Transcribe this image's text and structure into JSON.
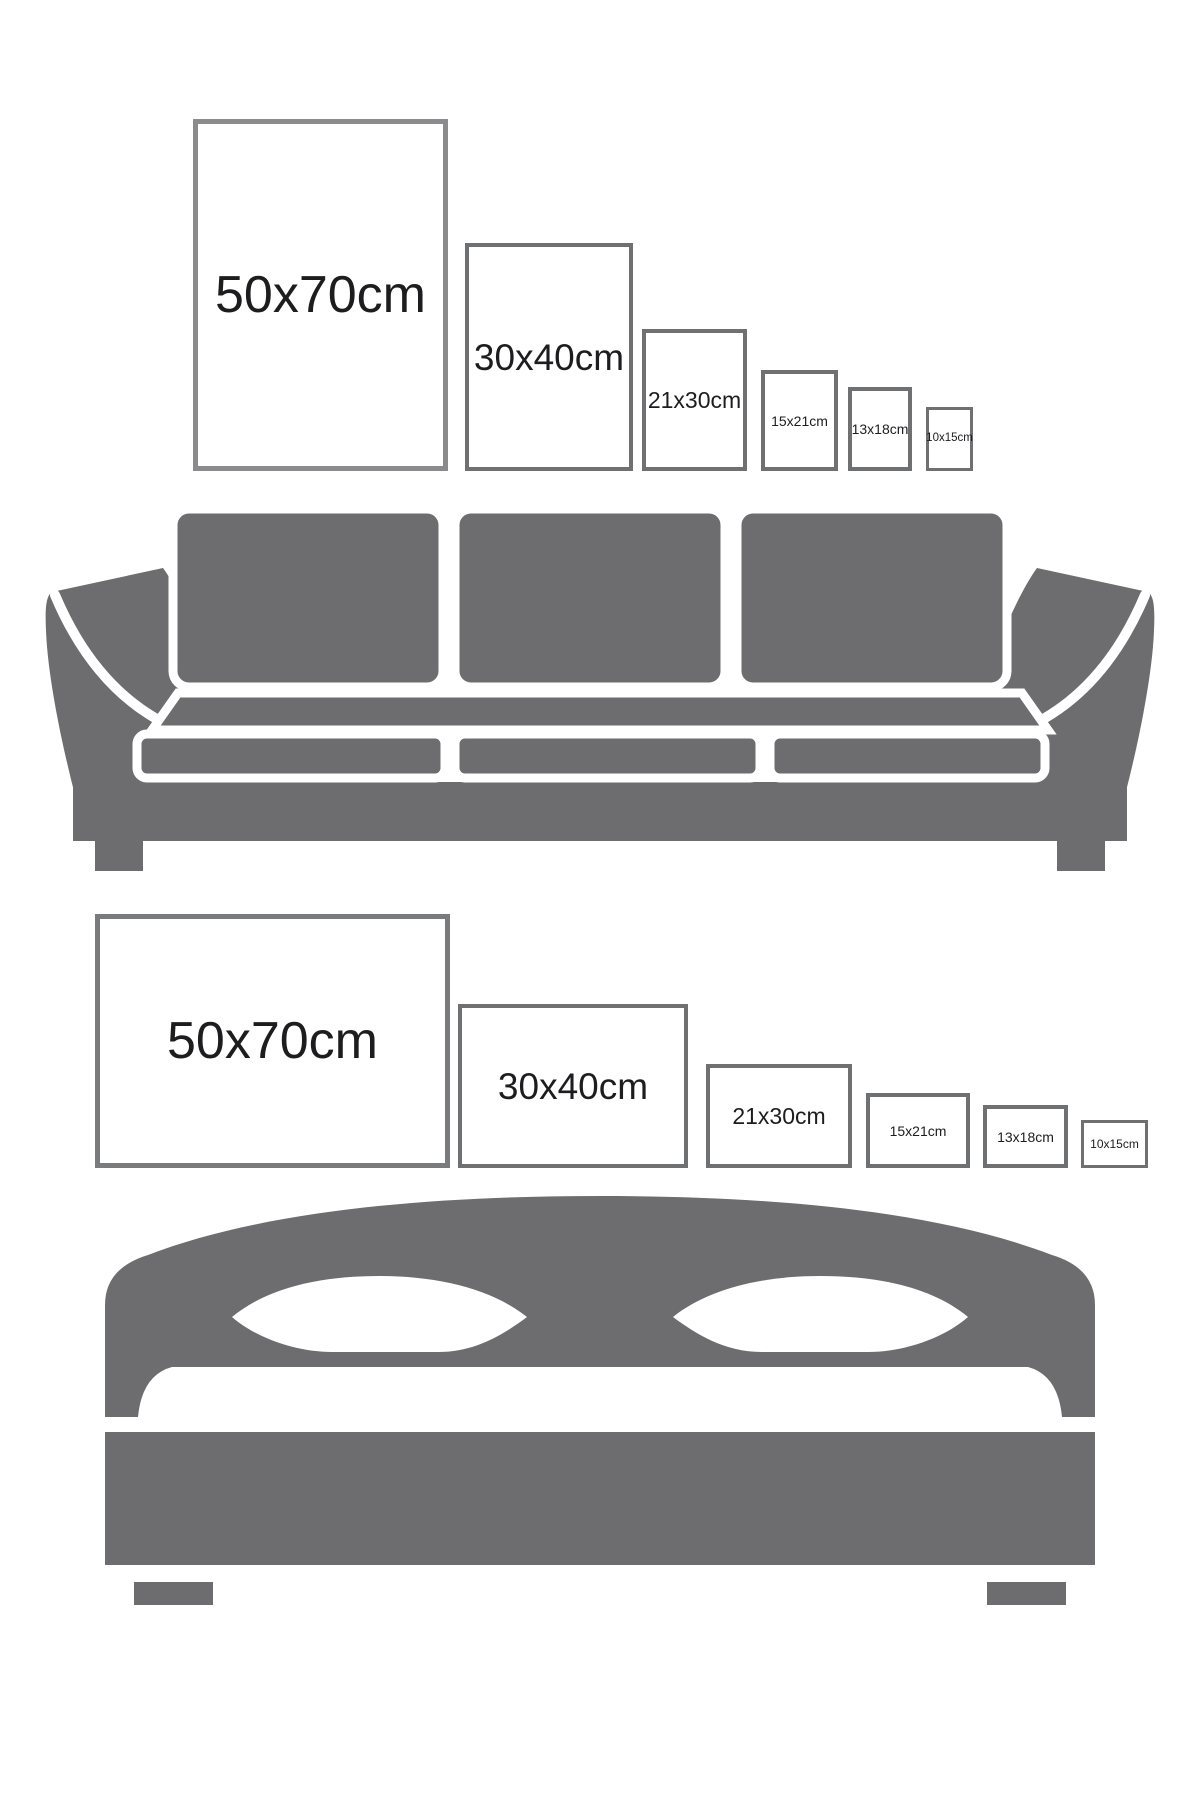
{
  "diagram_title": "Poster size comparison guide",
  "colors": {
    "furniture_gray": "#6d6d6f",
    "frame_border": "#6f7072",
    "frame_border_large_top": "#8b8b8d",
    "frame_border_large_bottom": "#7a7b7d",
    "label_text": "#1d1d1f",
    "background": "#ffffff"
  },
  "top_section": {
    "furniture_icon": "sofa-icon",
    "frame_orientation": "portrait",
    "frames": [
      {
        "label": "50x70cm"
      },
      {
        "label": "30x40cm"
      },
      {
        "label": "21x30cm"
      },
      {
        "label": "15x21cm"
      },
      {
        "label": "13x18cm"
      },
      {
        "label": "10x15cm"
      }
    ]
  },
  "bottom_section": {
    "furniture_icon": "bed-icon",
    "frame_orientation": "landscape",
    "frames": [
      {
        "label": "50x70cm"
      },
      {
        "label": "30x40cm"
      },
      {
        "label": "21x30cm"
      },
      {
        "label": "15x21cm"
      },
      {
        "label": "13x18cm"
      },
      {
        "label": "10x15cm"
      }
    ]
  }
}
